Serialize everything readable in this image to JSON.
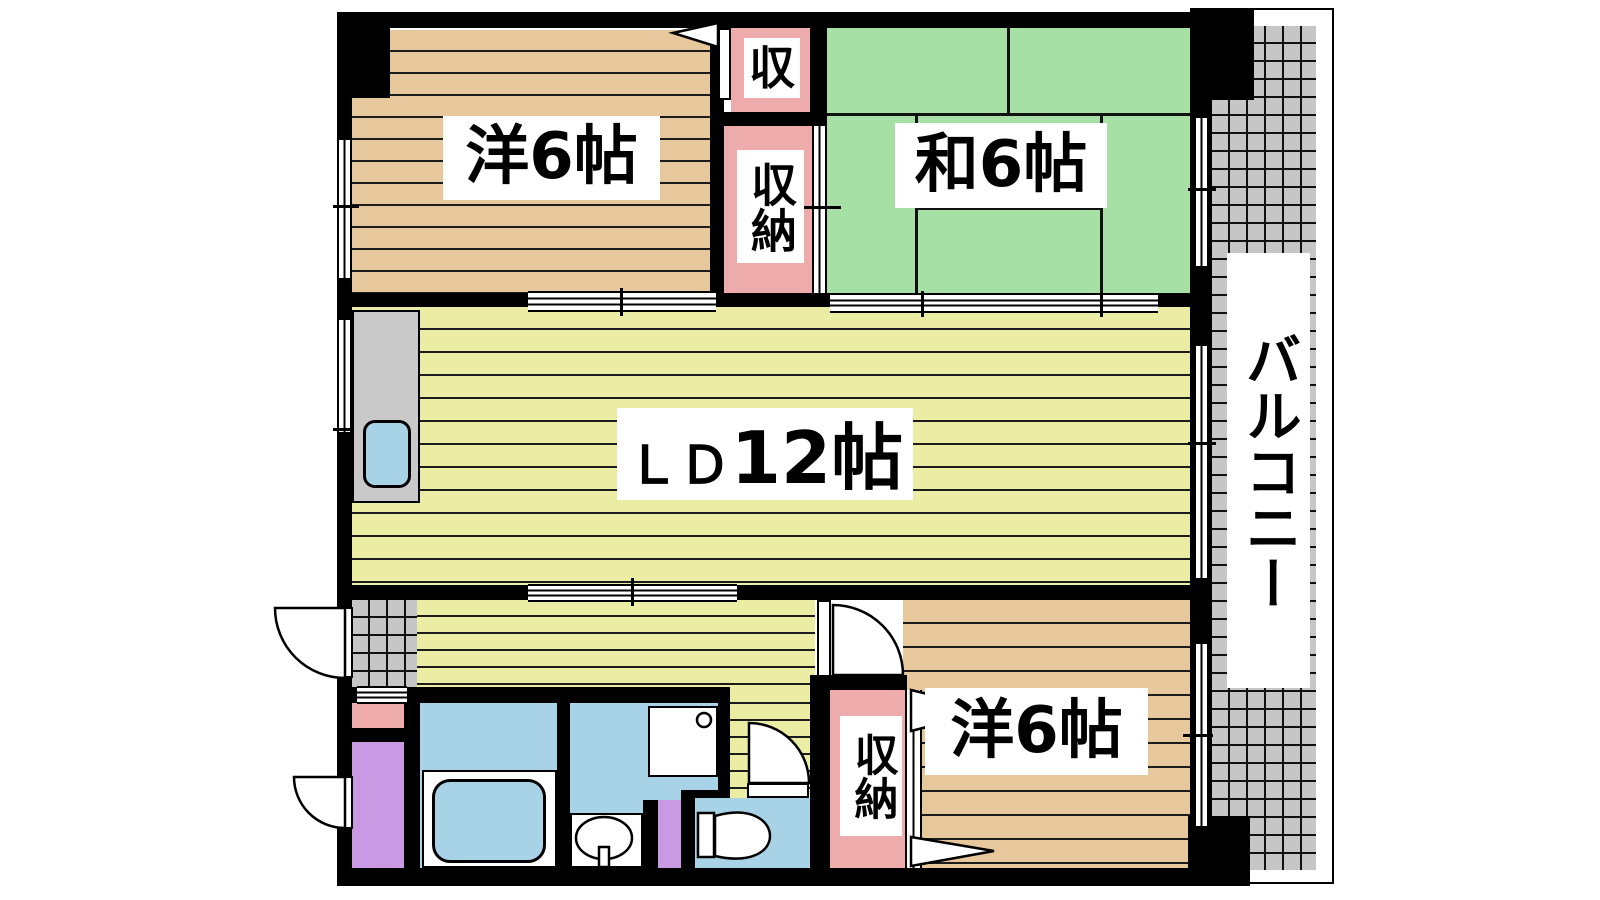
{
  "floorplan": {
    "labels": {
      "room_west_top": "洋6帖",
      "room_japanese": "和6帖",
      "ld_prefix": "ＬＤ",
      "ld_size": "12帖",
      "room_west_bottom": "洋6帖",
      "closet_small": "収",
      "closet_upper": "収納",
      "closet_lower": "収納",
      "balcony": "バルコニー"
    },
    "colors": {
      "wall": "#000000",
      "wood-floor": "#e7c89d",
      "tatami": "#a7e0a4",
      "ld-floor": "#eaeda3",
      "closet-pink": "#eeabab",
      "water-blue": "#a8d3e6",
      "cabinet-purple": "#c999e3",
      "tile-gray": "#c6c6c6",
      "counter-gray": "#c9c9c9",
      "stripe-line": "#1c1c1c",
      "grid-line": "#111111",
      "paper": "#ffffff"
    }
  }
}
